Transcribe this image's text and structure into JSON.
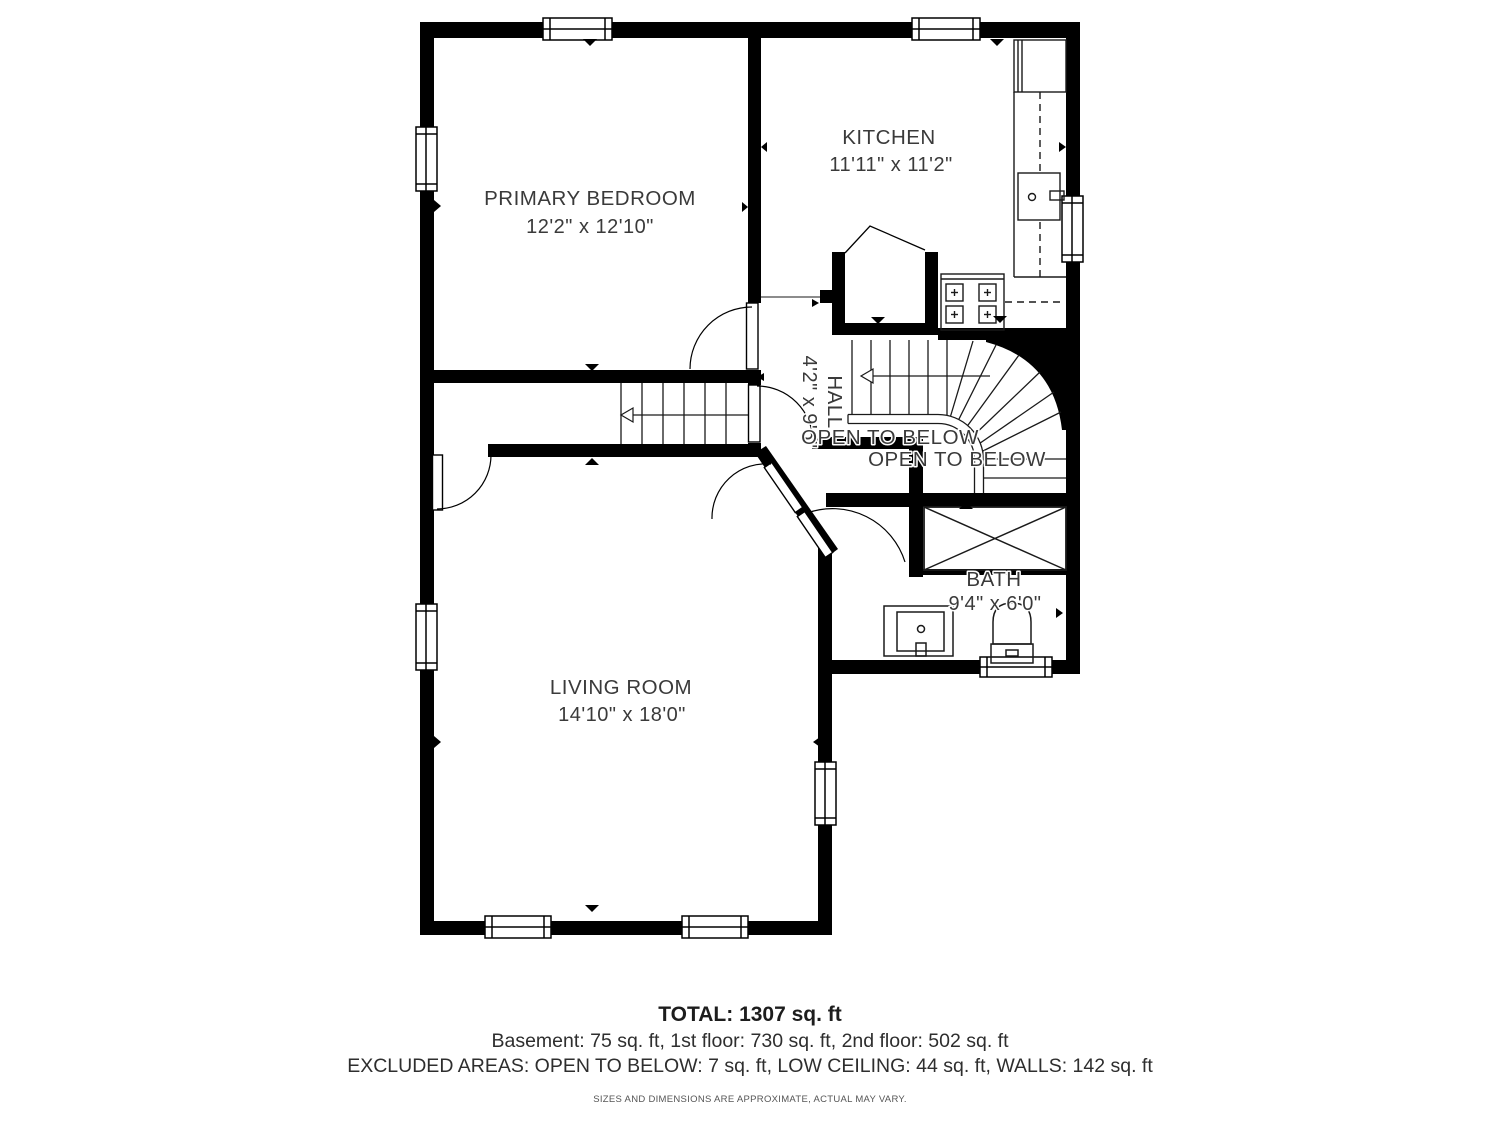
{
  "plan": {
    "labels": {
      "primary_bedroom": {
        "name": "PRIMARY BEDROOM",
        "dims": "12'2\" x 12'10\""
      },
      "kitchen": {
        "name": "KITCHEN",
        "dims": "11'11\" x 11'2\""
      },
      "hall": {
        "name": "HALL",
        "dims": "4'2\" x 9'6\""
      },
      "living_room": {
        "name": "LIVING ROOM",
        "dims": "14'10\" x 18'0\""
      },
      "bath": {
        "name": "BATH",
        "dims": "9'4\" x 6'0\""
      },
      "open_to_below_1": "OPEN TO BELOW",
      "open_to_below_2": "OPEN TO BELOW"
    },
    "colors": {
      "wall": "#000000",
      "text": "#3a3a3a",
      "background": "#ffffff"
    }
  },
  "footer": {
    "total": "TOTAL: 1307 sq. ft",
    "floors": "Basement: 75 sq. ft, 1st floor: 730 sq. ft, 2nd floor: 502 sq. ft",
    "excluded": "EXCLUDED AREAS: OPEN TO BELOW: 7 sq. ft, LOW CEILING: 44 sq. ft, WALLS: 142 sq. ft",
    "disclaimer": "SIZES AND DIMENSIONS ARE APPROXIMATE, ACTUAL MAY VARY."
  }
}
